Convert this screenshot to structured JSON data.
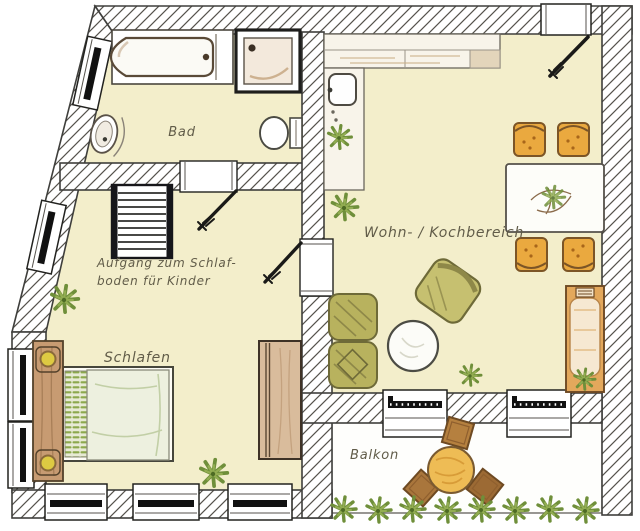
{
  "figure": {
    "type": "floor-plan",
    "language": "de"
  },
  "rooms": [
    {
      "id": "bad",
      "label": "Bad"
    },
    {
      "id": "wohn-kochbereich",
      "label": "Wohn- / Kochbereich"
    },
    {
      "id": "schlafen",
      "label": "Schlafen"
    },
    {
      "id": "balkon",
      "label": "Balkon"
    }
  ],
  "annotations": [
    {
      "id": "loft-stairs-note",
      "line1": "Aufgang zum Schlaf-",
      "line2": "boden für Kinder"
    }
  ],
  "colors": {
    "floor": "#f3eecb",
    "wall_line": "#3f3f3c",
    "label_text": "#615c49",
    "wood": "#d9bc9c",
    "cushion_orange": "#eaa93f",
    "seat_olive": "#b8b25e",
    "plant_green": "#6f8f3a",
    "balcony_table": "#eebc55"
  }
}
